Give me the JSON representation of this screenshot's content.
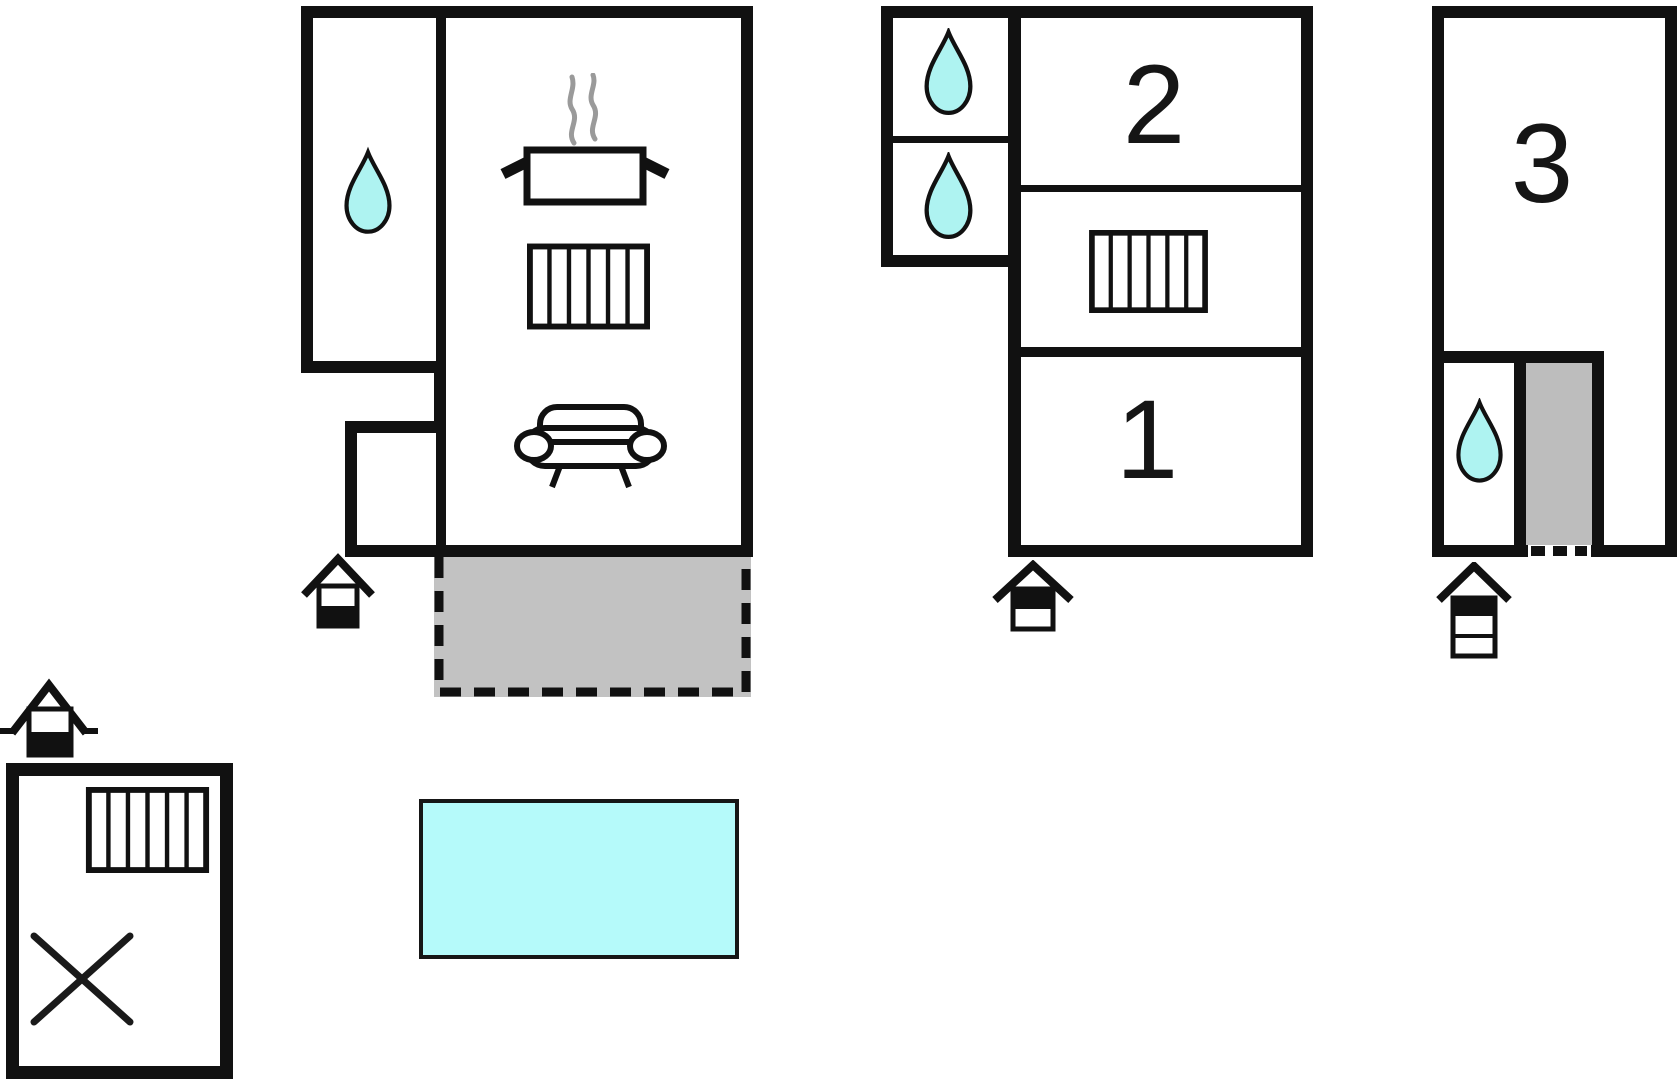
{
  "scene": "holiday-home floor plan",
  "background": "#ffffff",
  "colors": {
    "wall": "#111111",
    "water": "#aef3f1",
    "pool": "#b5fafa",
    "terrace": "#c2c2c2",
    "stairs": "#bdbdbd",
    "steam": "#9a9a9a"
  },
  "rooms": {
    "bedroom1": {
      "label": "1"
    },
    "bedroom2": {
      "label": "2"
    },
    "unit3": {
      "label": "3"
    }
  },
  "features": {
    "bathrooms_with_water_drop": 4,
    "entrance_markers": 4,
    "radiators": 3,
    "kitchen_icons": [
      "cooking-pot-icon",
      "steam-icon"
    ],
    "living_icons": [
      "sofa-icon"
    ],
    "outbuilding_icons": [
      "radiator-icon",
      "x-cross-icon"
    ],
    "terrace": "gray dashed area below main house",
    "stairs": "gray strip inside unit 3",
    "pool": "cyan rectangle"
  }
}
